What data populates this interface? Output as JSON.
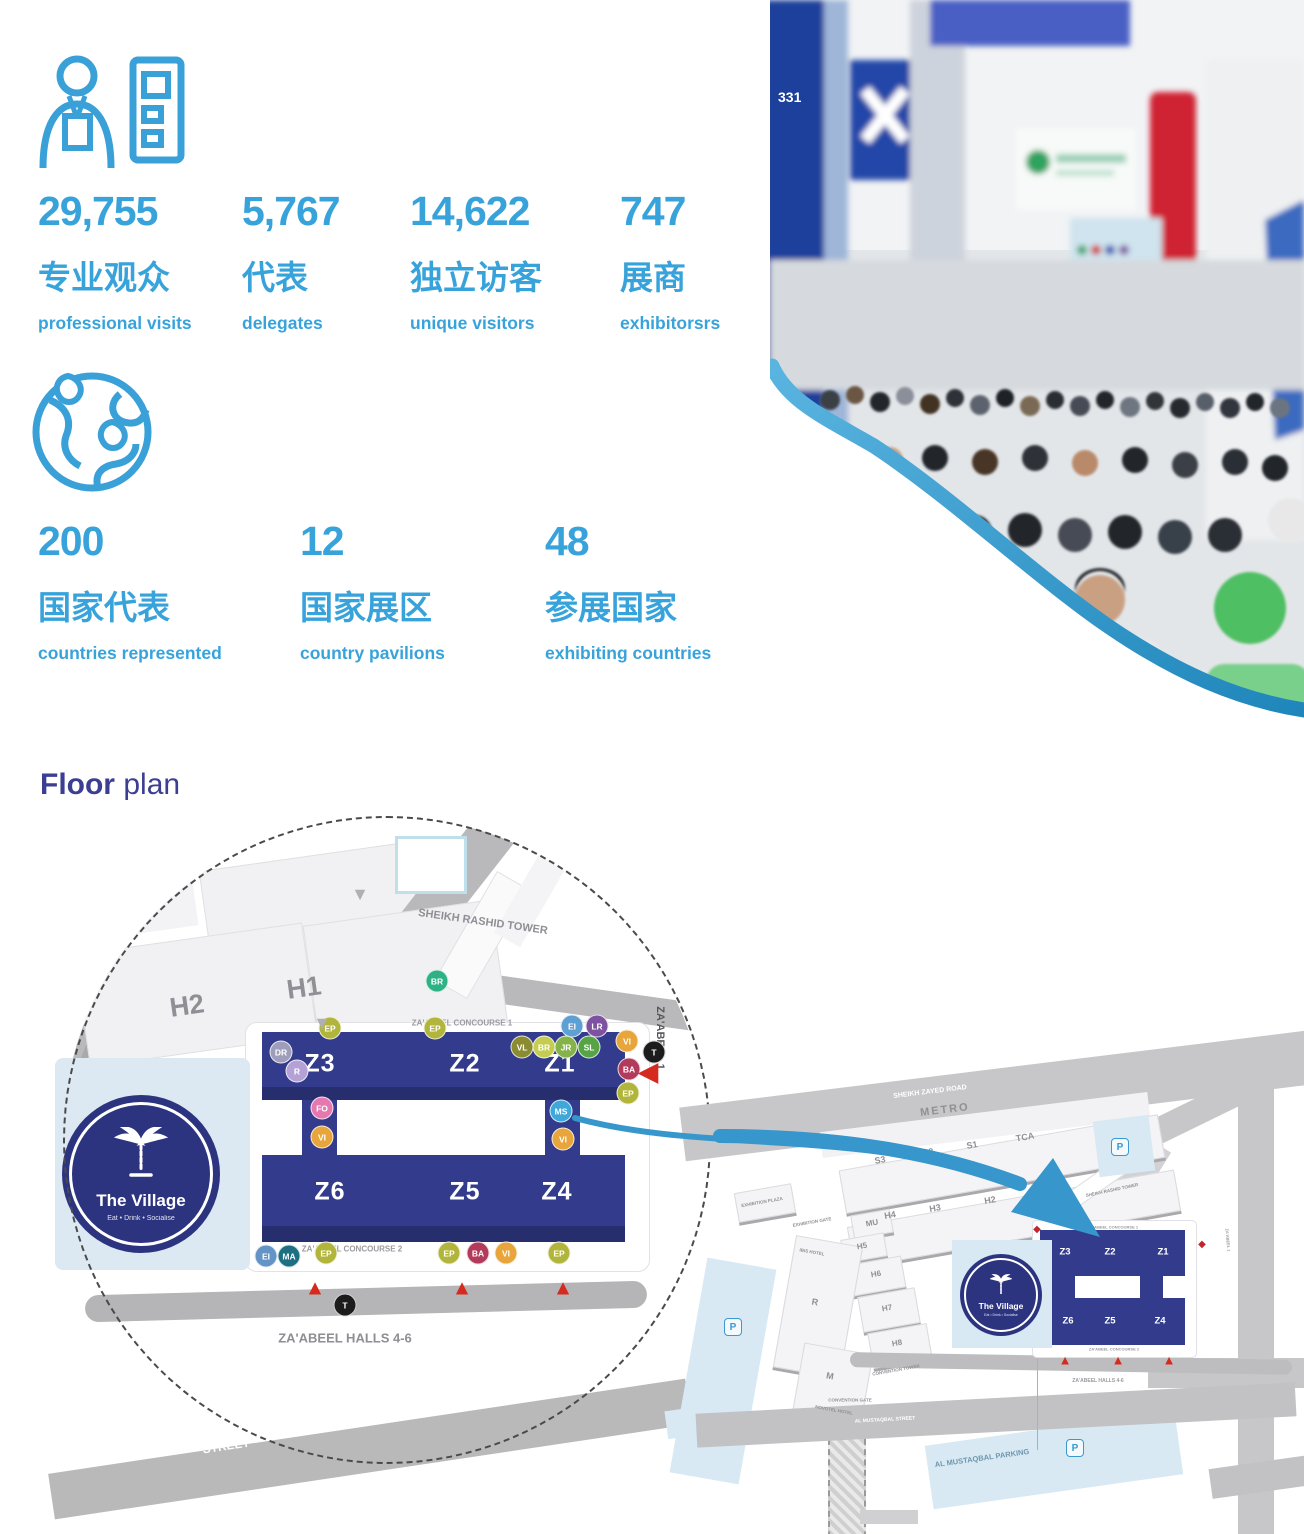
{
  "stats": {
    "accent_color": "#38a3db",
    "rows": [
      [
        {
          "x": 38,
          "value": "29,755",
          "label_zh": "专业观众",
          "label_en": "professional visits"
        },
        {
          "x": 242,
          "value": "5,767",
          "label_zh": "代表",
          "label_en": "delegates"
        },
        {
          "x": 410,
          "value": "14,622",
          "label_zh": "独立访客",
          "label_en": "unique visitors"
        },
        {
          "x": 620,
          "value": "747",
          "label_zh": "展商",
          "label_en": "exhibitorsrs"
        }
      ],
      [
        {
          "x": 38,
          "value": "200",
          "label_zh": "国家代表",
          "label_en": "countries represented"
        },
        {
          "x": 300,
          "value": "12",
          "label_zh": "国家展区",
          "label_en": "country pavilions"
        },
        {
          "x": 545,
          "value": "48",
          "label_zh": "参展国家",
          "label_en": "exhibiting countries"
        }
      ]
    ]
  },
  "photo": {
    "booth_number": "331"
  },
  "floor_plan": {
    "title_bold": "Floor",
    "title_rest": "plan",
    "village": {
      "name": "The Village",
      "tagline": "Eat • Drink • Socialise"
    },
    "detail": {
      "halls": [
        {
          "t": "H2",
          "x": 124,
          "y": 190,
          "s": 27,
          "r": -8
        },
        {
          "t": "H1",
          "x": 241,
          "y": 172,
          "s": 27,
          "r": -8
        }
      ],
      "tower_label": "SHEIKH RASHID TOWER",
      "zones_top": [
        {
          "t": "Z3",
          "x": 290,
          "y": 254
        },
        {
          "t": "Z2",
          "x": 435,
          "y": 254
        },
        {
          "t": "Z1",
          "x": 530,
          "y": 254
        }
      ],
      "zones_bottom": [
        {
          "t": "Z6",
          "x": 300,
          "y": 382
        },
        {
          "t": "Z5",
          "x": 435,
          "y": 382
        },
        {
          "t": "Z4",
          "x": 527,
          "y": 382
        }
      ],
      "texts": [
        {
          "t": "ZA'ABEEL CONCOURSE 1",
          "x": 432,
          "y": 213,
          "s": 8,
          "c": "#9a9aa0",
          "b": 1
        },
        {
          "t": "ZA'ABEEL CONCOURSE 2",
          "x": 322,
          "y": 439,
          "s": 8,
          "c": "#9a9aa0",
          "b": 1
        },
        {
          "t": "ZA'ABEEL HALLS 4-6",
          "x": 315,
          "y": 528,
          "s": 13,
          "c": "#8e8e94",
          "b": 1
        },
        {
          "t": "ZA'ABEEL 1",
          "x": 630,
          "y": 228,
          "s": 11,
          "c": "#55555c",
          "b": 1,
          "r": 90
        },
        {
          "t": "STREET",
          "x": 196,
          "y": 636,
          "s": 12,
          "c": "#ffffff",
          "b": 1,
          "r": -8.5
        }
      ],
      "badges": [
        {
          "label": "EP",
          "x": 300,
          "y": 218,
          "c": "#b2b53b"
        },
        {
          "label": "EP",
          "x": 405,
          "y": 218,
          "c": "#b2b53b"
        },
        {
          "label": "EI",
          "x": 542,
          "y": 216,
          "c": "#5e9fd4"
        },
        {
          "label": "LR",
          "x": 567,
          "y": 216,
          "c": "#7c52a1"
        },
        {
          "label": "VL",
          "x": 492,
          "y": 237,
          "c": "#8b8b32"
        },
        {
          "label": "BR",
          "x": 514,
          "y": 237,
          "c": "#c5cc52"
        },
        {
          "label": "JR",
          "x": 536,
          "y": 237,
          "c": "#85b34a"
        },
        {
          "label": "SL",
          "x": 559,
          "y": 237,
          "c": "#56a446"
        },
        {
          "label": "DR",
          "x": 251,
          "y": 242,
          "c": "#9e9ebc"
        },
        {
          "label": "R",
          "x": 267,
          "y": 261,
          "c": "#b4a2d6"
        },
        {
          "label": "VI",
          "x": 597,
          "y": 231,
          "c": "#e7a53c"
        },
        {
          "label": "T",
          "x": 624,
          "y": 242,
          "c": "#1c1c1c"
        },
        {
          "label": "BA",
          "x": 599,
          "y": 259,
          "c": "#b23a5a"
        },
        {
          "label": "EP",
          "x": 598,
          "y": 283,
          "c": "#b2b53b"
        },
        {
          "label": "FO",
          "x": 292,
          "y": 298,
          "c": "#e678b0"
        },
        {
          "label": "VI",
          "x": 292,
          "y": 327,
          "c": "#e7a53c"
        },
        {
          "label": "MS",
          "x": 531,
          "y": 301,
          "c": "#3ea8da"
        },
        {
          "label": "VI",
          "x": 533,
          "y": 329,
          "c": "#e7a53c"
        },
        {
          "label": "EI",
          "x": 236,
          "y": 446,
          "c": "#6494c6"
        },
        {
          "label": "MA",
          "x": 259,
          "y": 446,
          "c": "#1e6f82"
        },
        {
          "label": "EP",
          "x": 296,
          "y": 443,
          "c": "#b2b53b"
        },
        {
          "label": "EP",
          "x": 419,
          "y": 443,
          "c": "#b2b53b"
        },
        {
          "label": "BA",
          "x": 448,
          "y": 443,
          "c": "#b23a5a"
        },
        {
          "label": "VI",
          "x": 476,
          "y": 443,
          "c": "#e7a53c"
        },
        {
          "label": "EP",
          "x": 529,
          "y": 443,
          "c": "#b2b53b"
        },
        {
          "label": "BR",
          "x": 407,
          "y": 171,
          "c": "#2eb185"
        },
        {
          "label": "T",
          "x": 315,
          "y": 495,
          "c": "#1c1c1c"
        }
      ],
      "red_arrows": [
        {
          "x": 618,
          "y": 262,
          "dir": "left"
        },
        {
          "x": 285,
          "y": 478,
          "dir": "up"
        },
        {
          "x": 432,
          "y": 478,
          "dir": "up"
        },
        {
          "x": 533,
          "y": 478,
          "dir": "up"
        }
      ],
      "gray_arrows": [
        {
          "x": 292,
          "y": 213
        },
        {
          "x": 330,
          "y": 84
        }
      ]
    },
    "overview": {
      "p": "P",
      "labels": [
        {
          "t": "SHEIKH ZAYED ROAD",
          "x": 230,
          "y": 52,
          "s": 7,
          "c": "#ffffff",
          "r": -7,
          "b": 1
        },
        {
          "t": "METRO",
          "x": 245,
          "y": 70,
          "s": 11,
          "c": "#8f8f95",
          "r": -7,
          "ls": 2
        },
        {
          "t": "S3",
          "x": 180,
          "y": 120,
          "s": 9,
          "r": -10
        },
        {
          "t": "S2",
          "x": 228,
          "y": 112,
          "s": 9,
          "r": -10
        },
        {
          "t": "S1",
          "x": 272,
          "y": 105,
          "s": 9,
          "r": -10
        },
        {
          "t": "TCA",
          "x": 325,
          "y": 97,
          "s": 9,
          "r": -10
        },
        {
          "t": "H4",
          "x": 190,
          "y": 175,
          "s": 9,
          "r": -10
        },
        {
          "t": "H3",
          "x": 235,
          "y": 168,
          "s": 9,
          "r": -10
        },
        {
          "t": "H2",
          "x": 290,
          "y": 160,
          "s": 9,
          "r": -10
        },
        {
          "t": "H1",
          "x": 335,
          "y": 152,
          "s": 9,
          "r": -10
        },
        {
          "t": "MU",
          "x": 172,
          "y": 183,
          "s": 8,
          "r": -10
        },
        {
          "t": "H5",
          "x": 162,
          "y": 206,
          "s": 8,
          "r": -10
        },
        {
          "t": "H6",
          "x": 176,
          "y": 234,
          "s": 8,
          "r": -10
        },
        {
          "t": "H7",
          "x": 187,
          "y": 268,
          "s": 8,
          "r": -10
        },
        {
          "t": "H8",
          "x": 197,
          "y": 303,
          "s": 8,
          "r": -10
        },
        {
          "t": "CONVENTION TOWER",
          "x": 196,
          "y": 330,
          "s": 4.5,
          "r": -10
        },
        {
          "t": "IBIS HOTEL",
          "x": 112,
          "y": 212,
          "s": 4.5,
          "r": 10
        },
        {
          "t": "R",
          "x": 115,
          "y": 262,
          "s": 9,
          "r": 10
        },
        {
          "t": "M",
          "x": 130,
          "y": 336,
          "s": 9,
          "r": 10
        },
        {
          "t": "NOVOTEL HOTEL",
          "x": 134,
          "y": 370,
          "s": 4.5,
          "r": 10
        },
        {
          "t": "EXHIBITION PLAZA",
          "x": 62,
          "y": 162,
          "s": 4.5,
          "r": -10
        },
        {
          "t": "EXHIBITION GATE",
          "x": 112,
          "y": 182,
          "s": 4.5,
          "r": -10
        },
        {
          "t": "SHEIKH RASHID TOWER",
          "x": 412,
          "y": 150,
          "s": 4.5,
          "r": -12
        },
        {
          "t": "CONVENTION GATE",
          "x": 150,
          "y": 360,
          "s": 4.5
        },
        {
          "t": "AL MUSTAQBAL PARKING",
          "x": 282,
          "y": 418,
          "s": 7.5,
          "c": "#6e97ad",
          "r": -8,
          "b": 1
        },
        {
          "t": "AL MUSTAQBAL STREET",
          "x": 185,
          "y": 380,
          "s": 5,
          "c": "#ffffff",
          "r": -3
        },
        {
          "t": "ZA'ABEEL CONCOURSE 1",
          "x": 413,
          "y": 187,
          "s": 4,
          "c": "#9a9aa0"
        },
        {
          "t": "ZA'ABEEL CONCOURSE 2",
          "x": 414,
          "y": 309,
          "s": 4,
          "c": "#9a9aa0"
        },
        {
          "t": "ZA'ABEEL HALLS 4-6",
          "x": 398,
          "y": 341,
          "s": 5,
          "c": "#9a9aa0"
        },
        {
          "t": "ZA'ABEEL 1",
          "x": 528,
          "y": 200,
          "s": 4,
          "c": "#9a9aa0",
          "r": 85
        }
      ],
      "zones": [
        {
          "t": "Z3",
          "x": 365,
          "y": 212
        },
        {
          "t": "Z2",
          "x": 410,
          "y": 212
        },
        {
          "t": "Z1",
          "x": 463,
          "y": 212
        },
        {
          "t": "Z6",
          "x": 368,
          "y": 281
        },
        {
          "t": "Z5",
          "x": 410,
          "y": 281
        },
        {
          "t": "Z4",
          "x": 460,
          "y": 281
        }
      ],
      "p_icons": [
        {
          "x": 33,
          "y": 287
        },
        {
          "x": 420,
          "y": 107
        },
        {
          "x": 375,
          "y": 408
        }
      ],
      "red_marks": [
        {
          "x": 337,
          "y": 190
        },
        {
          "x": 502,
          "y": 205
        }
      ],
      "red_arrows": [
        {
          "x": 365,
          "y": 320
        },
        {
          "x": 418,
          "y": 320
        },
        {
          "x": 469,
          "y": 320
        }
      ]
    }
  }
}
